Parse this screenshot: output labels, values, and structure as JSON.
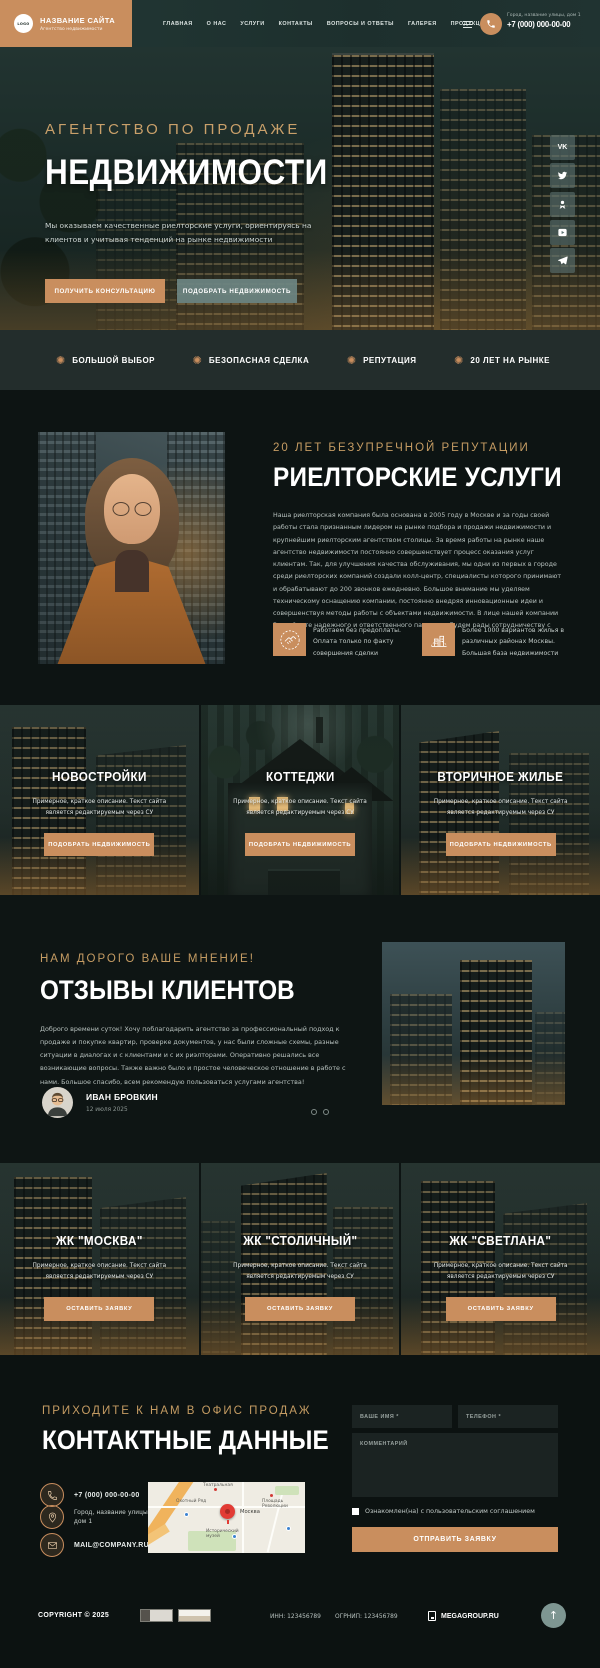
{
  "header": {
    "logo_text": "LOGO",
    "site_name": "НАЗВАНИЕ САЙТА",
    "site_tagline": "Агентство недвижимости",
    "nav": [
      "ГЛАВНАЯ",
      "О НАС",
      "УСЛУГИ",
      "КОНТАКТЫ",
      "ВОПРОСЫ И ОТВЕТЫ",
      "ГАЛЕРЕЯ",
      "ПРОДУКЦИЯ"
    ],
    "address": "Город, название улицы, дом 1",
    "phone": "+7 (000) 000-00-00"
  },
  "hero": {
    "subtitle": "АГЕНТСТВО ПО ПРОДАЖЕ",
    "title": "НЕДВИЖИМОСТИ",
    "description": "Мы оказываем качественные риелторские услуги, ориентируясь на клиентов и учитывая тенденций на рынке недвижимости",
    "btn_primary": "ПОЛУЧИТЬ КОНСУЛЬТАЦИЮ",
    "btn_secondary": "ПОДОБРАТЬ НЕДВИЖИМОСТЬ",
    "socials": [
      "vk",
      "twitter",
      "odnoklassniki",
      "youtube",
      "telegram"
    ]
  },
  "features": [
    "БОЛЬШОЙ ВЫБОР",
    "БЕЗОПАСНАЯ СДЕЛКА",
    "РЕПУТАЦИЯ",
    "20 ЛЕТ НА РЫНКЕ"
  ],
  "about": {
    "subtitle": "20 ЛЕТ БЕЗУПРЕЧНОЙ РЕПУТАЦИИ",
    "title": "РИЕЛТОРСКИЕ УСЛУГИ",
    "text": "Наша риелторская компания была основана в 2005 году в Москве и за годы своей работы стала признанным лидером на рынке подбора и продажи недвижимости и крупнейшим риелторским агентством столицы. За время работы на рынке наше агентство недвижимости постоянно совершенствует процесс оказания услуг клиентам. Так, для улучшения качества обслуживания, мы одни из первых в городе среди риелторских компаний создали колл-центр, специалисты которого принимают и обрабатывают до 200 звонков ежедневно. Большое внимание мы уделяем техническому оснащению компании, постоянно внедряя инновационные идеи и совершенствуя методы работы с объектами недвижимости. В лице нашей компании Вы найдете надежного и ответственного партнера. Будем рады сотрудничеству с Вами!",
    "benefits": [
      {
        "icon": "handshake-icon",
        "text": "Работаем без предоплаты. Оплата только по факту совершения сделки"
      },
      {
        "icon": "buildings-icon",
        "text": "Более 1000 вариантов жилья в различных районах Москвы. Большая база недвижимости"
      }
    ]
  },
  "categories": {
    "button_label": "ПОДОБРАТЬ НЕДВИЖИМОСТЬ",
    "items": [
      {
        "title": "НОВОСТРОЙКИ",
        "desc": "Примерное, краткое описание. Текст сайта является редактируемым через СУ"
      },
      {
        "title": "КОТТЕДЖИ",
        "desc": "Примерное, краткое описание. Текст сайта является редактируемым через СУ"
      },
      {
        "title": "ВТОРИЧНОЕ ЖИЛЬЕ",
        "desc": "Примерное, краткое описание. Текст сайта является редактируемым через СУ"
      }
    ]
  },
  "reviews": {
    "subtitle": "НАМ ДОРОГО ВАШЕ МНЕНИЕ!",
    "title": "ОТЗЫВЫ КЛИЕНТОВ",
    "text": "Доброго времени суток! Хочу поблагодарить агентство за профессиональный подход к продаже и покупке квартир, проверке документов, у нас были сложные схемы, разные ситуации в диалогах и с клиентами и с их риэлторами. Оперативно решались все возникающие вопросы. Также важно было и простое человеческое отношение в работе с нами. Большое спасибо, всем рекомендую пользоваться услугами агентства!",
    "author": "ИВАН БРОВКИН",
    "date": "12 июля 2025"
  },
  "complexes": {
    "button_label": "ОСТАВИТЬ ЗАЯВКУ",
    "items": [
      {
        "title": "ЖК \"МОСКВА\"",
        "desc": "Примерное, краткое описание. Текст сайта является редактируемым через СУ"
      },
      {
        "title": "ЖК \"СТОЛИЧНЫЙ\"",
        "desc": "Примерное, краткое описание. Текст сайта является редактируемым через СУ"
      },
      {
        "title": "ЖК \"СВЕТЛАНА\"",
        "desc": "Примерное, краткое описание. Текст сайта является редактируемым через СУ"
      }
    ]
  },
  "contact": {
    "subtitle": "ПРИХОДИТЕ К НАМ В ОФИС ПРОДАЖ",
    "title": "КОНТАКТНЫЕ ДАННЫЕ",
    "phone": "+7 (000) 000-00-00",
    "address": "Город, название улицы, дом 1",
    "email": "MAIL@COMPANY.RU",
    "map": {
      "city": "Москва",
      "labels": [
        "Театральная",
        "Охотный Ряд",
        "Площадь Революции",
        "Исторический музей"
      ]
    },
    "form": {
      "name_placeholder": "ВАШЕ ИМЯ *",
      "phone_placeholder": "ТЕЛЕФОН *",
      "comment_placeholder": "КОММЕНТАРИЙ",
      "agreement": "Ознакомлен(на) с пользовательским соглашением",
      "submit_label": "ОТПРАВИТЬ ЗАЯВКУ"
    }
  },
  "footer": {
    "copyright": "COPYRIGHT © 2025",
    "inn": "ИНН: 123456789",
    "ogrnip": "ОГРНИП: 123456789",
    "developer": "MEGAGROUP.RU"
  },
  "colors": {
    "accent_tan": "#c98e5e",
    "accent_gold": "#c59c63",
    "dark_bg": "#0d1413",
    "teal_header": "#1f3230",
    "slate_button": "#6c8583"
  }
}
